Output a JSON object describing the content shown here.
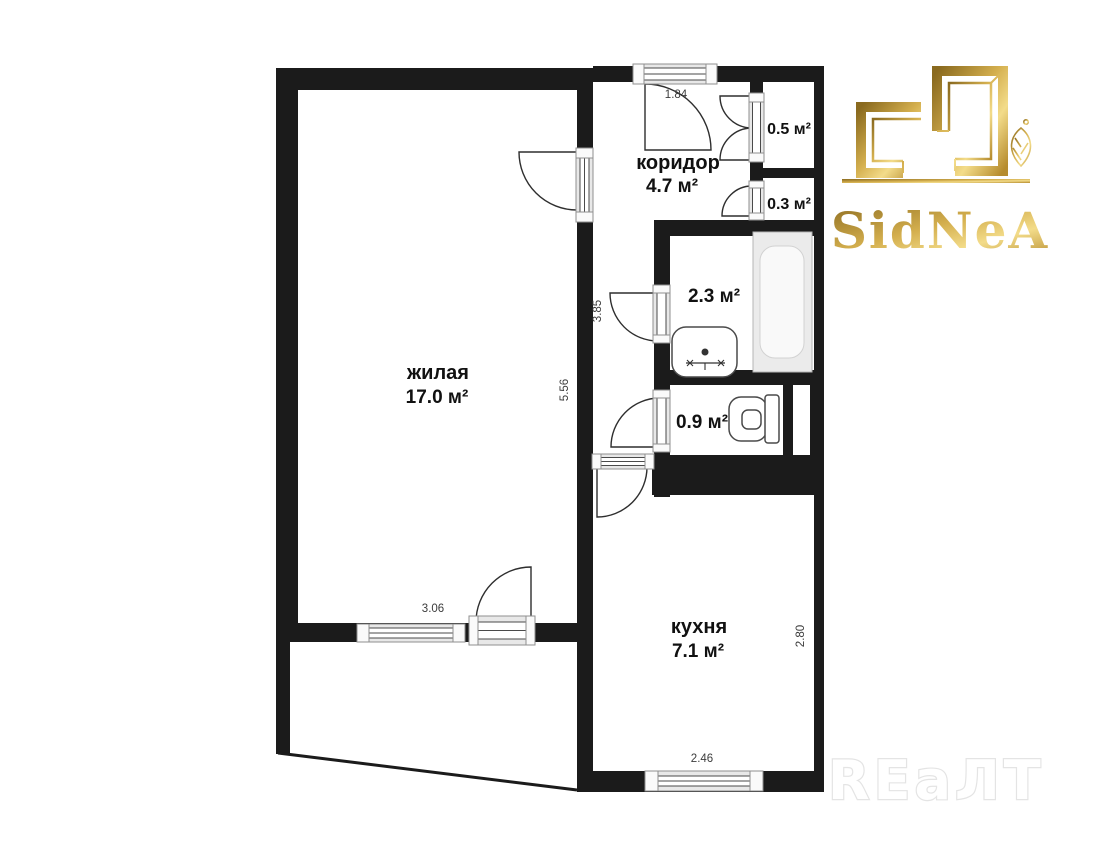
{
  "document": {
    "type": "apartment-floor-plan"
  },
  "branding": {
    "agency_logo_text": "SidNeA",
    "watermark_text": "REaЛT",
    "gold_color": "#C9A03E"
  },
  "rooms": {
    "living": {
      "name": "жилая",
      "area": "17.0 м²"
    },
    "corridor": {
      "name": "коридор",
      "area": "4.7 м²"
    },
    "kitchen": {
      "name": "кухня",
      "area": "7.1 м²"
    },
    "closet_top": {
      "area": "0.5 м²"
    },
    "closet_bottom": {
      "area": "0.3 м²"
    },
    "bathroom": {
      "area": "2.3 м²"
    },
    "toilet": {
      "area": "0.9 м²"
    }
  },
  "dimensions": {
    "entrance_width": "1.84",
    "corridor_length": "3.85",
    "living_length": "5.56",
    "living_width": "3.06",
    "kitchen_length": "2.80",
    "kitchen_window_width": "2.46"
  },
  "colors": {
    "wall": "#1B1B1B",
    "background": "#FFFFFF"
  }
}
